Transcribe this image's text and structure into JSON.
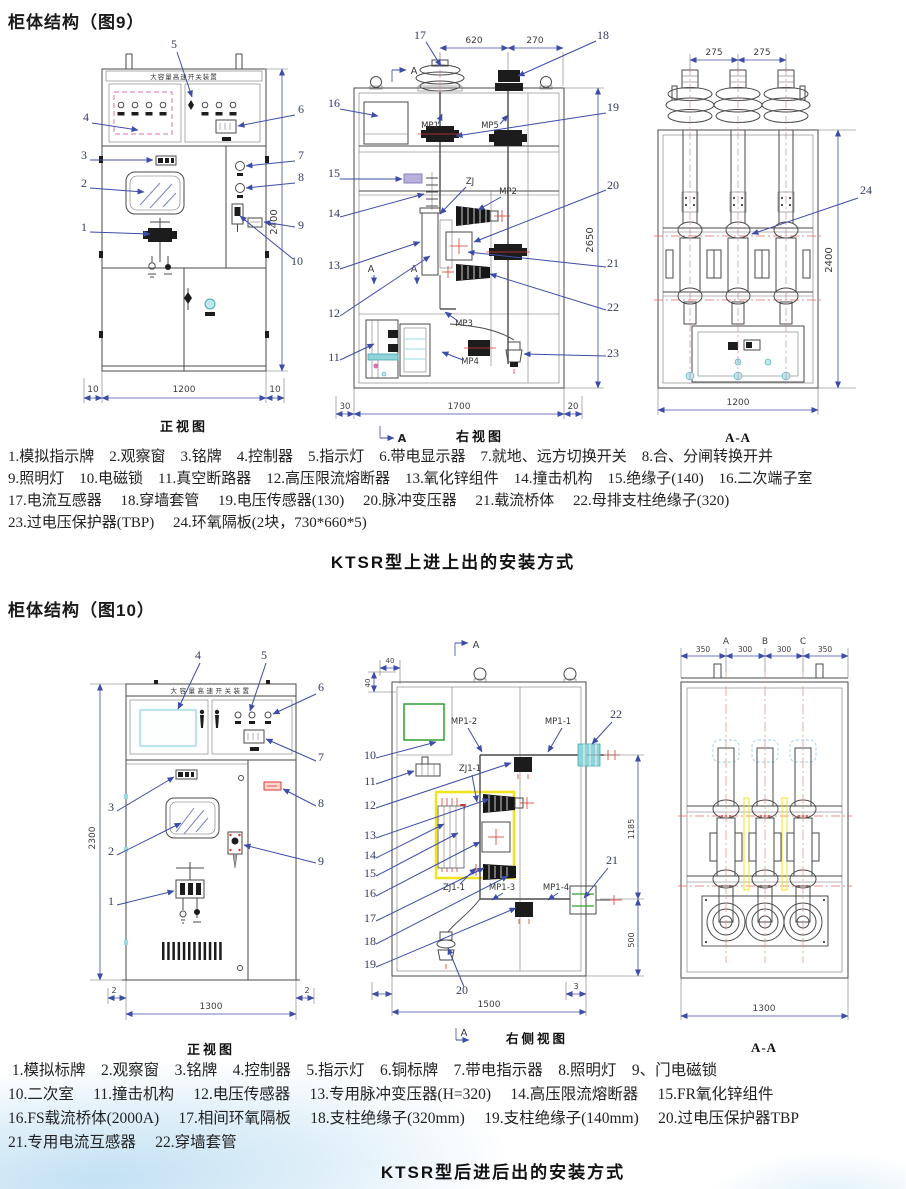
{
  "page": {
    "title1": "柜体结构（图9）",
    "title2": "柜体结构（图10）",
    "caption1": "KTSR型上进上出的安装方式",
    "caption2": "KTSR型后进后出的安装方式"
  },
  "fig9": {
    "front": {
      "banner": "大容量高速开关装置",
      "title": "正视图",
      "callouts": [
        "1",
        "2",
        "3",
        "4",
        "5",
        "6",
        "7",
        "8",
        "9",
        "10"
      ],
      "dims": {
        "l": "10",
        "w": "1200",
        "r": "10",
        "h": "2400"
      }
    },
    "right": {
      "title": "右视图",
      "marker": "A",
      "labels": {
        "mp1": "MP1",
        "mp5": "MP5",
        "zj": "ZJ",
        "mp2": "MP2",
        "mp3": "MP3",
        "mp4": "MP4"
      },
      "callouts": [
        "11",
        "12",
        "13",
        "14",
        "15",
        "16",
        "17",
        "18",
        "19",
        "20",
        "21",
        "22",
        "23"
      ],
      "dims": {
        "t1": "620",
        "t2": "270",
        "h": "2650",
        "b1": "30",
        "b2": "1700",
        "b3": "20"
      }
    },
    "aa": {
      "title": "A-A",
      "callout": "24",
      "dims": {
        "t1": "275",
        "t2": "275",
        "h": "2400",
        "w": "1200"
      }
    },
    "parts": [
      "1.模拟指示牌    2.观察窗    3.铭牌    4.控制器    5.指示灯    6.带电显示器    7.就地、远方切换开关    8.合、分闸转换开并",
      "9.照明灯    10.电磁锁    11.真空断路器    12.高压限流熔断器    13.氧化锌组件    14.撞击机构    15.绝缘子(140)    16.二次端子室",
      "17.电流互感器     18.穿墙套管     19.电压传感器(130)     20.脉冲变压器     21.载流桥体     22.母排支柱绝缘子(320)",
      "23.过电压保护器(TBP)     24.环氧隔板(2块，730*660*5)"
    ]
  },
  "fig10": {
    "front": {
      "banner": "大容量高速开关装置",
      "title": "正视图",
      "callouts": [
        "1",
        "2",
        "3",
        "4",
        "5",
        "6",
        "7",
        "8",
        "9"
      ],
      "dims": {
        "h": "2300",
        "w": "1300",
        "l": "2",
        "r": "2"
      }
    },
    "side": {
      "title": "右侧视图",
      "marker": "A",
      "labels": {
        "mp12": "MP1-2",
        "mp11": "MP1-1",
        "zj11a": "ZJ1-1",
        "zj11b": "ZJ1-1",
        "mp13": "MP1-3",
        "mp14": "MP1-4"
      },
      "callouts": [
        "10",
        "11",
        "12",
        "13",
        "14",
        "15",
        "16",
        "17",
        "18",
        "19",
        "20",
        "21",
        "22"
      ],
      "dims": {
        "a": "40",
        "b": "40",
        "h1": "1185",
        "h2": "500",
        "w": "1500",
        "d3": "3"
      }
    },
    "aa": {
      "title": "A-A",
      "phases": [
        "A",
        "B",
        "C"
      ],
      "dims": {
        "d1": "350",
        "d2": "300",
        "d3": "300",
        "d4": "350",
        "w": "1300"
      }
    },
    "parts": [
      " 1.模拟标牌    2.观察窗    3.铭牌    4.控制器    5.指示灯    6.铜标牌    7.带电指示器    8.照明灯    9、门电磁锁",
      "10.二次室     11.撞击机构     12.电压传感器     13.专用脉冲变压器(H=320)     14.高压限流熔断器     15.FR氧化锌组件",
      "16.FS载流桥体(2000A)     17.相间环氧隔板     18.支柱绝缘子(320mm)     19.支柱绝缘子(140mm)     20.过电压保护器TBP",
      "21.专用电流互感器     22.穿墙套管"
    ]
  }
}
